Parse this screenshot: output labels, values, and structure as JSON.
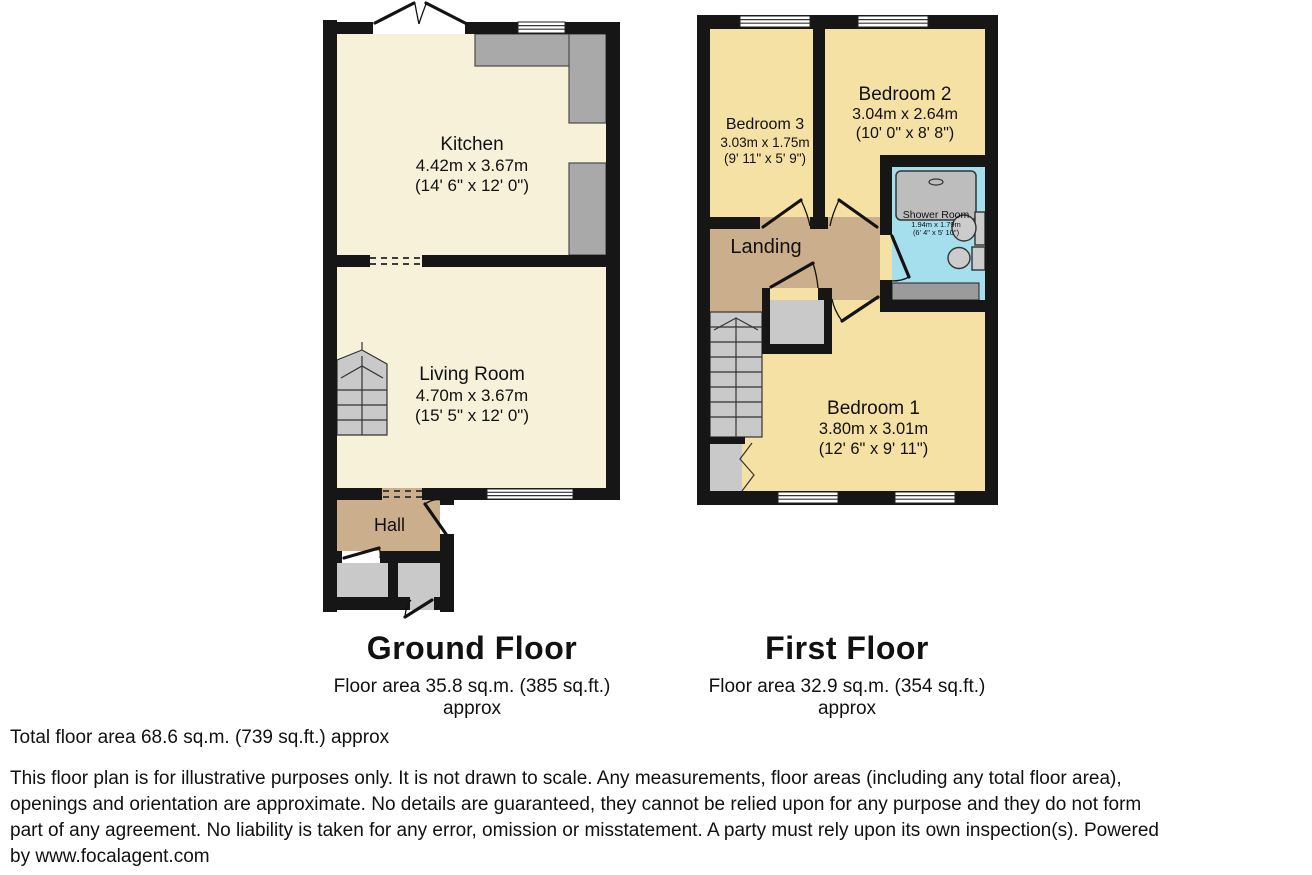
{
  "colors": {
    "wall": "#161616",
    "cream": "#f7f1da",
    "yellow": "#f5e1a4",
    "tan": "#cbae8c",
    "cyan": "#a5dfee",
    "lightgray": "#c9c9c9",
    "counter": "#a9a9a9",
    "tray": "#bdbdbd",
    "fixture": "#cccccc",
    "cabinet": "#9b9b9b"
  },
  "ground_floor": {
    "title": "Ground Floor",
    "area_line": "Floor area 35.8 sq.m. (385 sq.ft.)",
    "approx_line": "approx",
    "rooms": {
      "kitchen": {
        "name": "Kitchen",
        "metric": "4.42m x 3.67m",
        "imperial": "(14' 6\" x 12' 0\")"
      },
      "living_room": {
        "name": "Living Room",
        "metric": "4.70m x 3.67m",
        "imperial": "(15' 5\" x 12' 0\")"
      },
      "hall": {
        "name": "Hall"
      }
    }
  },
  "first_floor": {
    "title": "First Floor",
    "area_line": "Floor area 32.9 sq.m. (354 sq.ft.)",
    "approx_line": "approx",
    "rooms": {
      "bedroom_1": {
        "name": "Bedroom 1",
        "metric": "3.80m x 3.01m",
        "imperial": "(12' 6\" x 9' 11\")"
      },
      "bedroom_2": {
        "name": "Bedroom 2",
        "metric": "3.04m x 2.64m",
        "imperial": "(10' 0\" x 8' 8\")"
      },
      "bedroom_3": {
        "name": "Bedroom 3",
        "metric": "3.03m x 1.75m",
        "imperial": "(9' 11\" x 5' 9\")"
      },
      "shower_room": {
        "name": "Shower Room",
        "metric": "1.94m x 1.79m",
        "imperial": "(6' 4\" x 5' 10\")"
      },
      "landing": {
        "name": "Landing"
      }
    }
  },
  "footer": {
    "total_line": "Total floor area 68.6 sq.m. (739 sq.ft.) approx",
    "disclaimer_lines": [
      "This floor plan is for illustrative purposes only. It is not drawn to scale. Any measurements, floor areas (including any total floor area),",
      "openings and orientation are approximate. No details are guaranteed, they cannot be relied upon for any purpose and they do not form",
      "part of any agreement. No liability is taken for any error, omission or misstatement. A party must rely upon its own inspection(s). Powered",
      "by www.focalagent.com"
    ]
  }
}
